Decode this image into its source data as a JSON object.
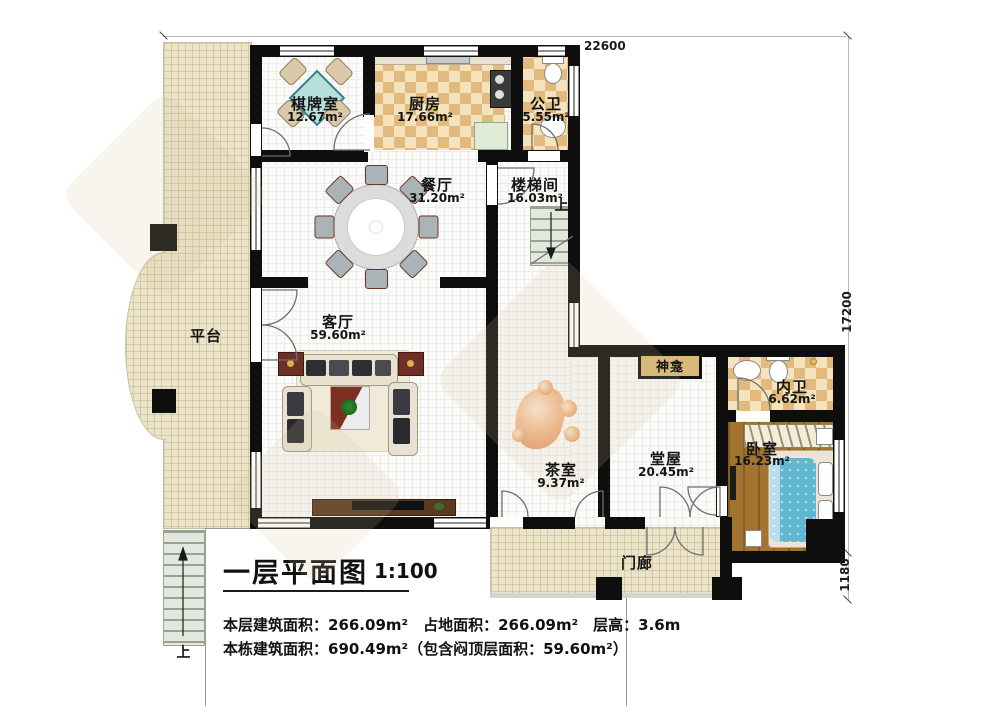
{
  "plan": {
    "title": "一层平面图",
    "scale": "1:100",
    "stats_line1": "本层建筑面积：266.09m²　占地面积：266.09m²　层高：3.6m",
    "stats_line2": "本栋建筑面积：690.49m²（包含闷顶层面积：59.60m²）"
  },
  "dimensions": {
    "top": "22600",
    "right": "17200",
    "bottom_right": "1180"
  },
  "rooms": [
    {
      "name": "棋牌室",
      "area": "12.67m²"
    },
    {
      "name": "厨房",
      "area": "17.66m²"
    },
    {
      "name": "公卫",
      "area": "5.55m²"
    },
    {
      "name": "餐厅",
      "area": "31.20m²"
    },
    {
      "name": "楼梯间",
      "area": "16.03m²"
    },
    {
      "name": "客厅",
      "area": "59.60m²"
    },
    {
      "name": "平台",
      "area": ""
    },
    {
      "name": "茶室",
      "area": "9.37m²"
    },
    {
      "name": "堂屋",
      "area": "20.45m²"
    },
    {
      "name": "神龛",
      "area": ""
    },
    {
      "name": "内卫",
      "area": "6.62m²"
    },
    {
      "name": "卧室",
      "area": "16.23m²"
    },
    {
      "name": "门廊",
      "area": ""
    }
  ],
  "annotations": {
    "stairwell_up": "上",
    "entry_up": "上"
  },
  "colors": {
    "wall": "#0e0e0e",
    "checker_dark": "#e3ba7e",
    "checker_light": "#f4e3bc",
    "terrace": "#ece4c9",
    "wood_floor": "#a3742f",
    "bed": "#5fb7d0",
    "mahjong_table": "#b7dfdc",
    "accent_red": "#7d2f22"
  }
}
